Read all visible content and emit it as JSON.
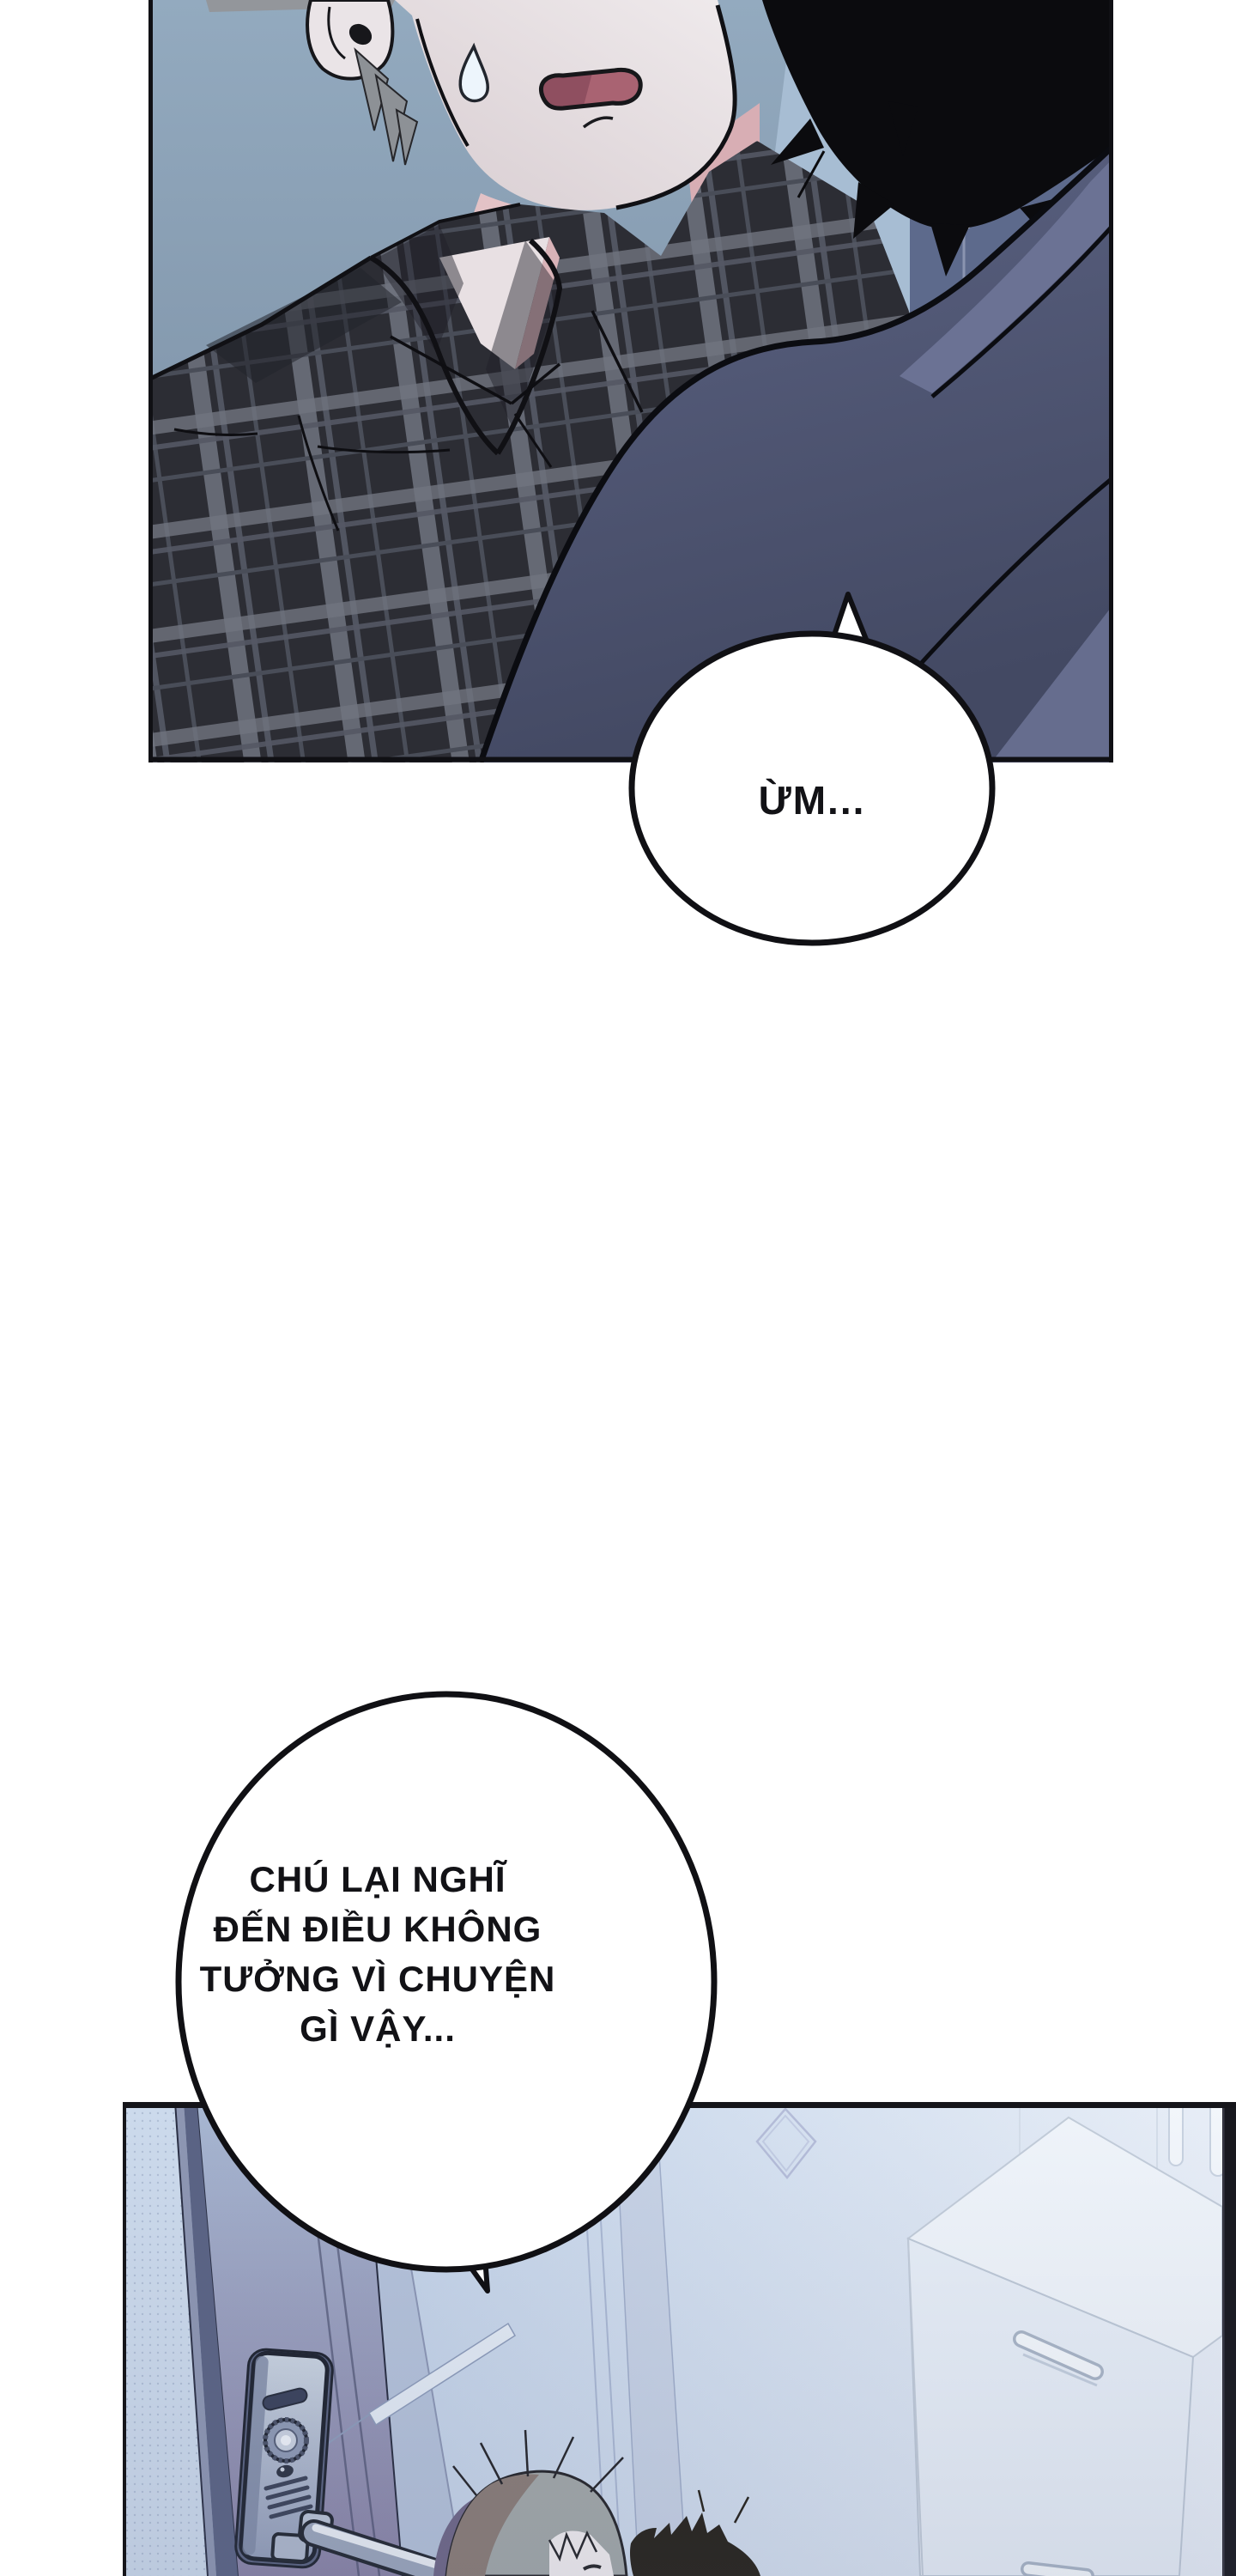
{
  "bubbles": [
    {
      "id": "um",
      "text": "ỪM..."
    },
    {
      "id": "question",
      "lines": [
        "CHÚ LẠI NGHĨ",
        "ĐẾN ĐIỀU KHÔNG",
        "TƯỞNG VÌ CHUYỆN",
        "GÌ VẬY..."
      ]
    }
  ],
  "colors": {
    "page_bg": "#ffffff",
    "outline": "#101014",
    "panel1_bg_top": "#93aabf",
    "panel1_bg_bottom": "#76899e",
    "bg_band_light": "#a7bdd3",
    "bg_band_dark": "#5d6a8c",
    "skin": "#eae5e8",
    "skin_shadow": "#d8aeb4",
    "mouth": "#a96372",
    "hair_gray": "#9aa0a2",
    "hair_black": "#0b0b0e",
    "plaid_base": "#2c2d34",
    "plaid_stripe": "#70747f",
    "jacket": "#555c7c",
    "panel2_wall": "#cfdced",
    "panel2_door": "#9590b2",
    "lock_body": "#b0bcce",
    "furniture_white": "#edf2f9"
  }
}
